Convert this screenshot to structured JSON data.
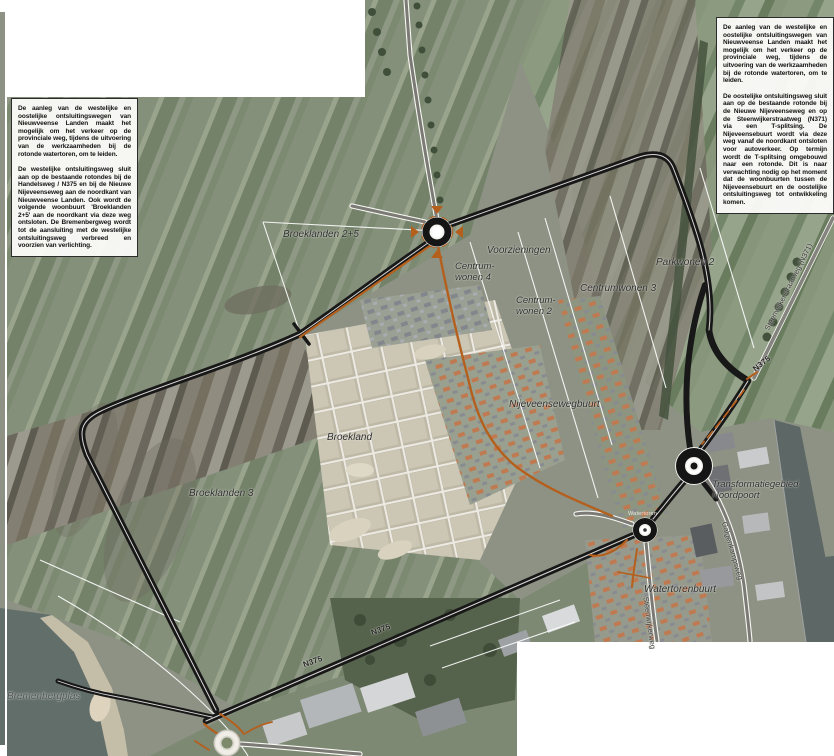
{
  "text_boxes": {
    "west": {
      "p1": "De aanleg van de westelijke en oostelijke ontsluitingswegen van Nieuwveense Landen maakt het mogelijk om het verkeer op de provinciale weg, tijdens de uitvoering van de werkzaamheden bij de rotonde watertoren, om te leiden.",
      "p2": "De westelijke ontsluitingsweg sluit aan op de bestaande rotondes bij de Handelsweg / N375 en bij de Nieuwe Nijeveenseweg aan de noordkant van Nieuwveense Landen. Ook wordt de volgende woonbuurt 'Broeklanden 2+5' aan de noordkant via deze weg ontsloten. De Bremenbergweg wordt tot de aansluiting met de westelijke ontsluitingsweg verbreed en voorzien van verlichting."
    },
    "east": {
      "p1": "De aanleg van de westelijke en oostelijke ontsluitingswegen van Nieuwveense Landen maakt het mogelijk om het verkeer op de provinciale weg, tijdens de uitvoering van de werkzaamheden bij de rotonde watertoren, om te leiden.",
      "p2": "De oostelijke ontsluitingsweg sluit aan op de bestaande rotonde bij de Nieuwe Nijeveenseweg en op de Steenwijkerstraatweg (N371) via een T-splitsing. De Nijeveensebuurt wordt via deze weg vanaf de noordkant ontsloten voor autoverkeer. Op termijn wordt de T-splitsing omgebouwd naar een rotonde. Dit is naar verwachting nodig op het moment dat de woonbuurten tussen de Nijeveensebuurt en de oostelijke ontsluitingsweg tot ontwikkeling komen."
    }
  },
  "labels": [
    {
      "text": "Broeklanden 2+5"
    },
    {
      "text": "Voorzieningen"
    },
    {
      "text": "Centrum-\nwonen 4"
    },
    {
      "text": "Centrum-\nwonen 2"
    },
    {
      "text": "Centrumwonen 3"
    },
    {
      "text": "Parkwonen 2"
    },
    {
      "text": "Nijeveensewegbuurt"
    },
    {
      "text": "Broekland"
    },
    {
      "text": "Broeklanden 3"
    },
    {
      "text": "Transformatiegebied\nNoordpoort"
    },
    {
      "text": "Watertorenbuurt"
    },
    {
      "text": "Bremenbergplas"
    },
    {
      "text": "Watertoren"
    },
    {
      "text": "N375"
    },
    {
      "text": "N375"
    },
    {
      "text": "N375"
    },
    {
      "text": "Steenwijkerstraatweg (N371)"
    },
    {
      "text": "Galgenkampsweg"
    },
    {
      "text": "Steenwijkerweg"
    }
  ],
  "colors": {
    "new_road": "#181818",
    "accent_road": "#b55f1d",
    "plan_line": "#ffffff",
    "water": "#5d6765",
    "photo_background": "#8d9284"
  }
}
